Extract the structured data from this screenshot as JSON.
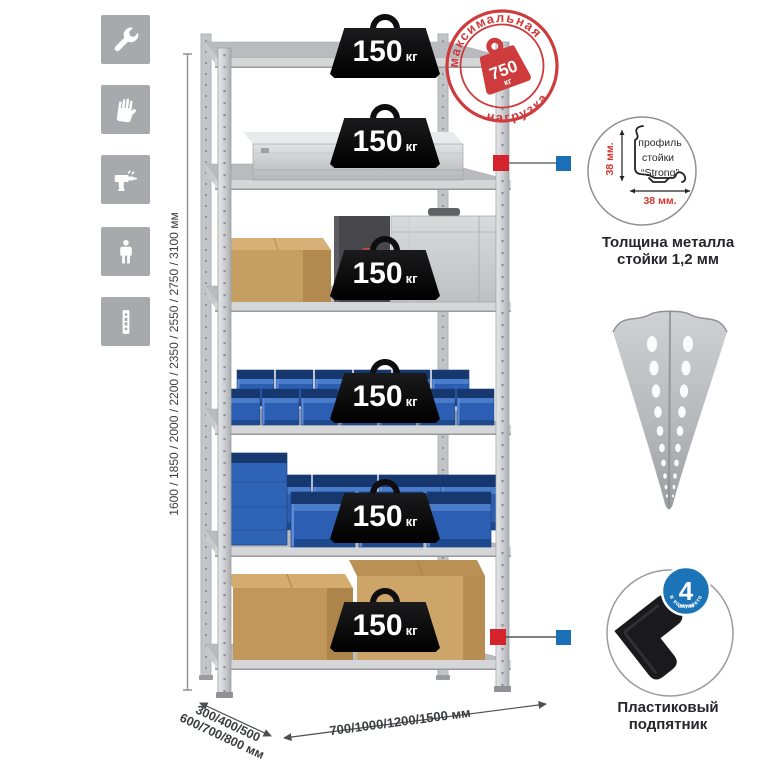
{
  "features": {
    "items": [
      {
        "name": "wrench"
      },
      {
        "name": "work-gloves"
      },
      {
        "name": "drill"
      },
      {
        "name": "person-height"
      },
      {
        "name": "perforated-post"
      }
    ]
  },
  "stamp": {
    "arc_top": "максимальная",
    "arc_bottom": "нагрузка",
    "value": "750",
    "unit": "кг"
  },
  "shelf_load_badges": [
    {
      "value": "150",
      "unit": "кг"
    },
    {
      "value": "150",
      "unit": "кг"
    },
    {
      "value": "150",
      "unit": "кг"
    },
    {
      "value": "150",
      "unit": "кг"
    },
    {
      "value": "150",
      "unit": "кг"
    },
    {
      "value": "150",
      "unit": "кг"
    }
  ],
  "dimensions": {
    "height_label": "1600 / 1850 / 2000 / 2200 / 2350 / 2550 / 2750 / 3100 мм",
    "depth_label_line1": "300/400/500",
    "depth_label_line2": "600/700/800 мм",
    "width_label": "700/1000/1200/1500 мм"
  },
  "profile_detail": {
    "dim_vertical": "38 мм.",
    "dim_horizontal": "38 мм.",
    "title_line1": "профиль",
    "title_line2": "стойки",
    "title_line3": "“Strong”",
    "caption_line1": "Толщина металла",
    "caption_line2": "стойки 1,2 мм"
  },
  "foot_detail": {
    "badge_value": "4",
    "badge_unit": "штуки",
    "badge_arc": "в комплекте",
    "caption_line1": "Пластиковый",
    "caption_line2": "подпятник"
  },
  "colors": {
    "stamp_red": "#cd3b3c",
    "callout_red": "#d5232b",
    "callout_blue": "#1a6fb5",
    "tile_gray": "#a7a9ac",
    "bin_blue": "#2c5fb3",
    "badge_black": "#0e0e10"
  }
}
